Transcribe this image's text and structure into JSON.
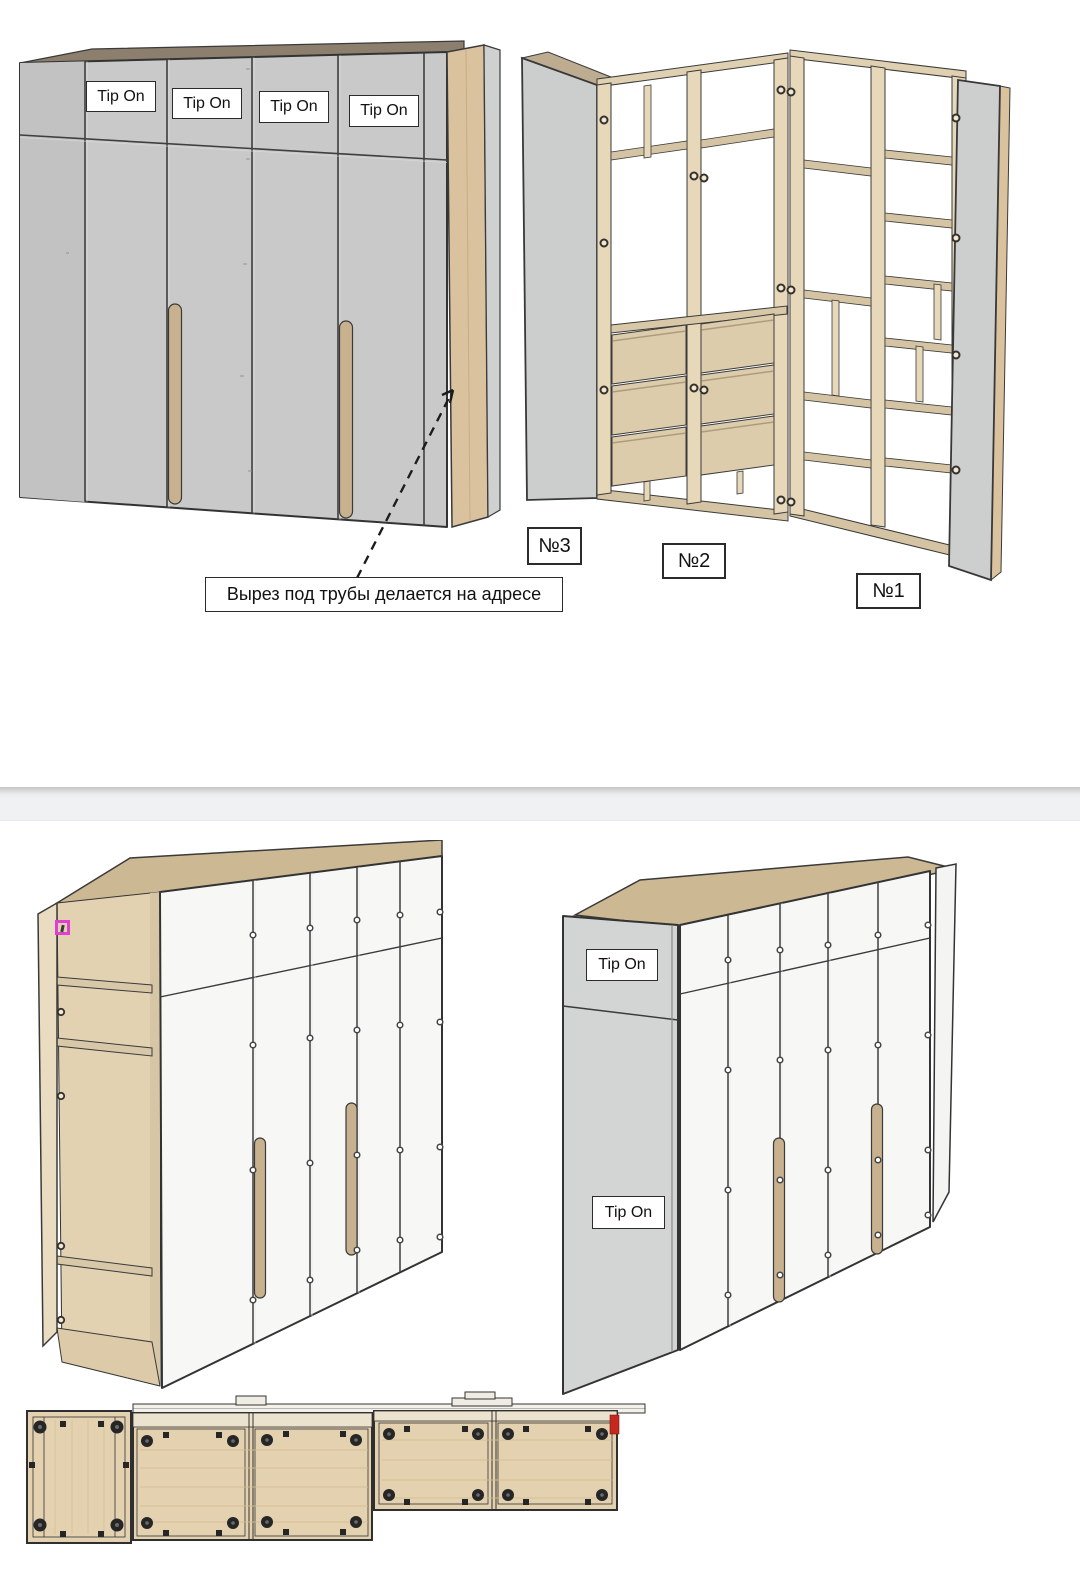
{
  "page1": {
    "closed_wardrobe": {
      "tip_on_labels": [
        "Tip On",
        "Tip On",
        "Tip On",
        "Tip On"
      ]
    },
    "callout_text": "Вырез под трубы делается на адресе",
    "unit_labels": [
      "№3",
      "№2",
      "№1"
    ]
  },
  "page2": {
    "gray_side_labels": [
      "Tip On",
      "Tip On"
    ]
  },
  "colors": {
    "wood_light": "#e7d8ba",
    "wood_shelf": "#d5c4a3",
    "wood_plan": "#e4d1af",
    "wood_top_dark": "#8c7f6d",
    "gray_door": "#c9c9c9",
    "gray_panel": "#cdcfcf",
    "white_door": "#f7f7f6",
    "outline": "#333333",
    "red_mark": "#c4281e",
    "pink_marker": "#e03fd0"
  }
}
